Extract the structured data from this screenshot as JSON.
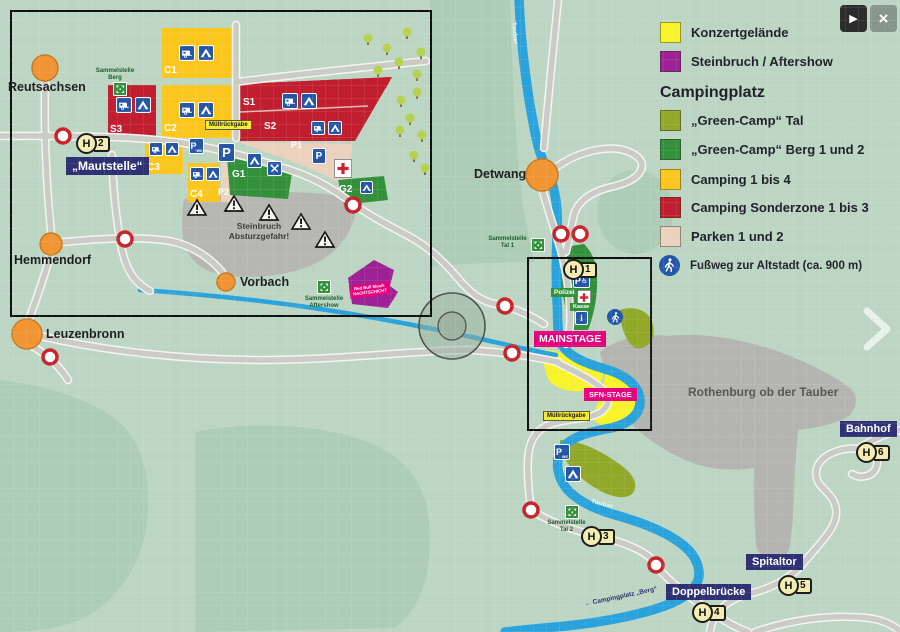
{
  "colors": {
    "map_bg": "#bcd6c3",
    "forest": "#aecdb6",
    "city": "#b4b4b0",
    "quarry": "#b7b7b1",
    "water": "#2aa3dd",
    "road": "#cbcbc6",
    "road_casing": "#f4f4f0",
    "konzert": "#f8f32a",
    "aftershow": "#9e2295",
    "green_tal": "#92a829",
    "green_berg": "#33913c",
    "camping": "#fbc71f",
    "sonderzone": "#c11f2f",
    "parken": "#ead2bf",
    "icon_blue": "#2456a8",
    "label_navy": "#2e3173",
    "stage_pink": "#e5007d",
    "town": "#f09434",
    "town_border": "#c87a20",
    "closure_red": "#c6252c",
    "tree": "#b5d24f",
    "tree_trunk": "#8a6f4d"
  },
  "controls": {
    "play": "▶",
    "close": "×"
  },
  "legend": {
    "camping_header": "Campingplatz",
    "items": [
      {
        "label": "Konzertgelände",
        "swatch": "konzert"
      },
      {
        "label": "Steinbruch / Aftershow",
        "swatch": "aftershow"
      },
      {
        "label": "„Green-Camp“ Tal",
        "swatch": "green_tal"
      },
      {
        "label": "„Green-Camp“ Berg 1 und 2",
        "swatch": "green_berg"
      },
      {
        "label": "Camping 1 bis 4",
        "swatch": "camping"
      },
      {
        "label": "Camping Sonderzone 1 bis 3",
        "swatch": "sonderzone"
      },
      {
        "label": "Parken 1 und 2",
        "swatch": "parken"
      }
    ],
    "footpath": "Fußweg zur Altstadt (ca. 900 m)"
  },
  "towns": {
    "reutsachsen": "Reutsachsen",
    "hemmendorf": "Hemmendorf",
    "leuzenbronn": "Leuzenbronn",
    "vorbach": "Vorbach",
    "detwang": "Detwang",
    "rothenburg": "Rothenburg ob der Tauber"
  },
  "signs": {
    "mautstelle": "„Mautstelle“",
    "bahnhof": "Bahnhof",
    "spitaltor": "Spitaltor",
    "doppelbruecke": "Doppelbrücke",
    "campingplatz_berg": "← Campingplatz „Berg“",
    "tauber": "Tauber"
  },
  "stages": {
    "mainstage": "MAINSTAGE",
    "sfn": "SFN-STAGE",
    "redbull_line1": "Red Bull Musik",
    "redbull_line2": "NACHTSCHICHT"
  },
  "zones": {
    "c1": "C1",
    "c2": "C2",
    "c3": "C3",
    "c4": "C4",
    "s1": "S1",
    "s2": "S2",
    "s3": "S3",
    "p1": "P1",
    "p2": "P2",
    "g1": "G1",
    "g2": "G2"
  },
  "facilities": {
    "polizei": "Polizei",
    "kasse": "Kasse",
    "muellrueckgabe": "Müllrückgabe",
    "steinbruch_warnung": "Steinbruch Absturzgefahr!",
    "sammelstelle_berg": "Sammelstelle Berg",
    "sammelstelle_tal1": "Sammelstelle Tal 1",
    "sammelstelle_tal2": "Sammelstelle Tal 2",
    "sammelstelle_aftershow": "Sammelstelle Aftershow",
    "parking": "P",
    "wc": "wc",
    "info": "i",
    "wheelchair": "♿"
  },
  "stops": {
    "letter": "H",
    "h1": "1",
    "h2": "2",
    "h3": "3",
    "h4": "4",
    "h5": "5",
    "h6": "6"
  }
}
